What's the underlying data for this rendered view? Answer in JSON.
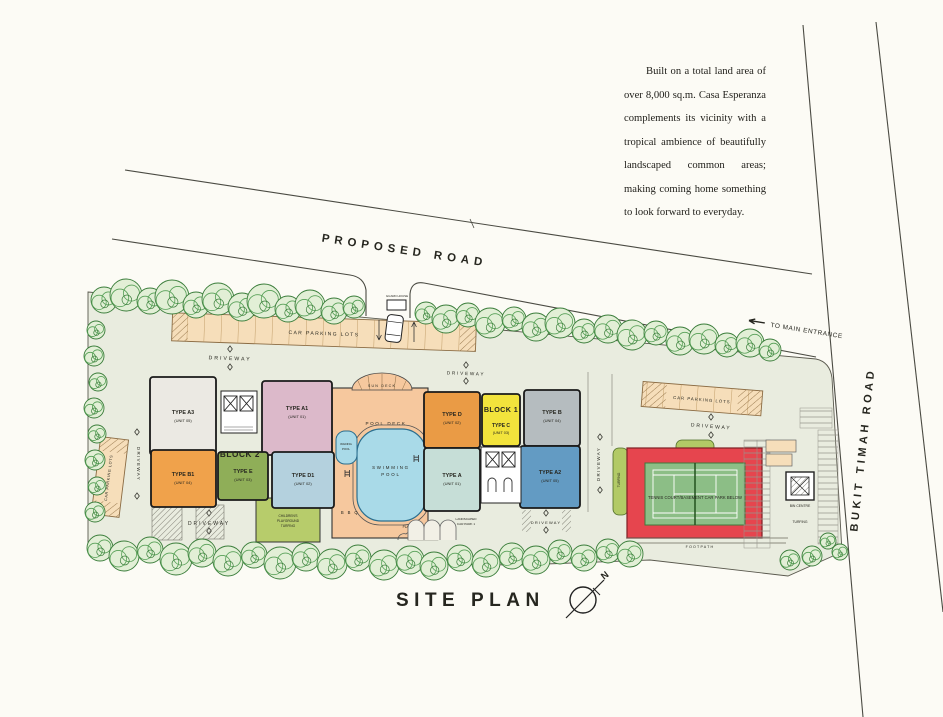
{
  "intro": {
    "text": "Built on a total land area of over 8,000 sq.m. Casa Esperanza complements its vicinity with a tropical ambience of beautifully landscaped common areas; making coming home something to look forward to everyday."
  },
  "roads": {
    "proposed_road": "PROPOSED ROAD",
    "boundary_line": "BOUNDARY LINE",
    "to_main_entrance": "TO MAIN ENTRANCE",
    "bukit_timah_road": "BUKIT TIMAH ROAD"
  },
  "title": {
    "site_plan": "SITE PLAN",
    "north": "N"
  },
  "labels": {
    "car_parking_lots": "CAR PARKING LOTS",
    "driveway": "DRIVEWAY",
    "guard_house": "GUARD HOUSE",
    "sun_deck": "SUN DECK",
    "pool_deck": "POOL DECK",
    "swimming_pool": [
      "SWIMMING",
      "POOL"
    ],
    "wading_pool": [
      "WADING",
      "POOL"
    ],
    "bbq": "B B Q",
    "planter": "PLANTER",
    "landscaped_car_park": [
      "LANDSCAPED",
      "CAR PARK 1"
    ],
    "children_playground": [
      "CHILDREN'S",
      "PLAYGROUND",
      "TURFING"
    ],
    "tennis_court": "TENNIS COURT/BASEMENT CAR PARK BELOW",
    "footpath": "FOOTPATH",
    "bin_centre": "BIN CENTRE",
    "turfing": "TURFING"
  },
  "blocks": [
    {
      "name": "BLOCK 2",
      "units": [
        {
          "type": "TYPE A3",
          "unit": "(UNIT 05)",
          "color": "#ebe9e3"
        },
        {
          "type": "TYPE A1",
          "unit": "(UNIT 01)",
          "color": "#dcb9ca"
        },
        {
          "type": "TYPE B1",
          "unit": "(UNIT 04)",
          "color": "#f0a24b"
        },
        {
          "type": "TYPE E",
          "unit": "(UNIT 03)",
          "color": "#8fae58"
        },
        {
          "type": "TYPE D1",
          "unit": "(UNIT 02)",
          "color": "#b4d1de"
        }
      ]
    },
    {
      "name": "BLOCK 1",
      "units": [
        {
          "type": "TYPE D",
          "unit": "(UNIT 02)",
          "color": "#ea9b45"
        },
        {
          "type": "TYPE C",
          "unit": "(UNIT 03)",
          "color": "#f2e33c"
        },
        {
          "type": "TYPE B",
          "unit": "(UNIT 04)",
          "color": "#b5bcbf"
        },
        {
          "type": "TYPE A",
          "unit": "(UNIT 01)",
          "color": "#c6ded7"
        },
        {
          "type": "TYPE A2",
          "unit": "(UNIT 05)",
          "color": "#639bc3"
        }
      ]
    }
  ],
  "colors": {
    "paper": "#fcfbf5",
    "ground": "#e9ecdf",
    "parking_tan": "#f6deba",
    "tree_green": "#3a7d3a",
    "turf": "#b2ca66",
    "playground": "#b7cc6b",
    "deck": "#f6c89e",
    "pool": "#a9dae8",
    "tennis_red": "#e6454e",
    "tennis_green": "#8cbe86",
    "line": "#4a4a42"
  }
}
